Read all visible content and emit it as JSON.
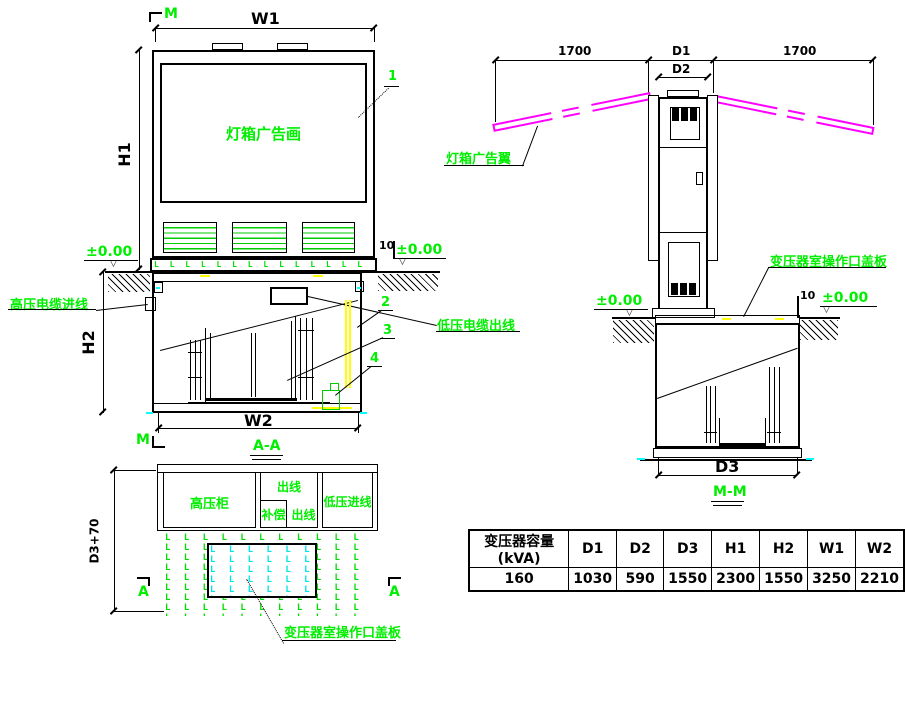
{
  "colors": {
    "annotation_green": "#00ee00",
    "wing_magenta": "#ff00ff",
    "cover_cyan": "#00e5e5",
    "cable_yellow": "#ffff00",
    "line_black": "#000000"
  },
  "front_view": {
    "marker_m_top": "M",
    "dim_w1": "W1",
    "dim_h1": "H1",
    "panel_label": "灯箱广告画",
    "callout_1": "1",
    "level_left": "±0.00",
    "level_right": "±0.00",
    "dim_10": "10",
    "level_symbol": "▽"
  },
  "section_aa": {
    "title": "A-A",
    "marker_m_bottom": "M",
    "dim_h2": "H2",
    "dim_w2": "W2",
    "label_hv_in": "高压电缆进线",
    "label_lv_out": "低压电缆出线",
    "callout_2": "2",
    "callout_3": "3",
    "callout_4": "4"
  },
  "side_view": {
    "dim_1700_left": "1700",
    "dim_d1": "D1",
    "dim_1700_right": "1700",
    "dim_d2": "D2",
    "label_wing": "灯箱广告翼",
    "label_cover": "变压器室操作口盖板",
    "level_left": "±0.00",
    "level_right": "±0.00",
    "dim_10": "10",
    "level_symbol": "▽"
  },
  "section_mm": {
    "title": "M-M",
    "dim_d3": "D3"
  },
  "plan_view": {
    "dim_height": "D3+70",
    "cabinet_hv": "高压柜",
    "cabinet_out_top": "出线",
    "cabinet_comp": "补偿",
    "cabinet_out_bottom": "出线",
    "cabinet_lv_in": "低压进线",
    "label_cover": "变压器室操作口盖板",
    "marker_a_left": "A",
    "marker_a_right": "A"
  },
  "spec_table": {
    "headers": [
      "变压器容量(kVA)",
      "D1",
      "D2",
      "D3",
      "H1",
      "H2",
      "W1",
      "W2"
    ],
    "rows": [
      [
        "160",
        "1030",
        "590",
        "1550",
        "2300",
        "1550",
        "3250",
        "2210"
      ]
    ]
  }
}
